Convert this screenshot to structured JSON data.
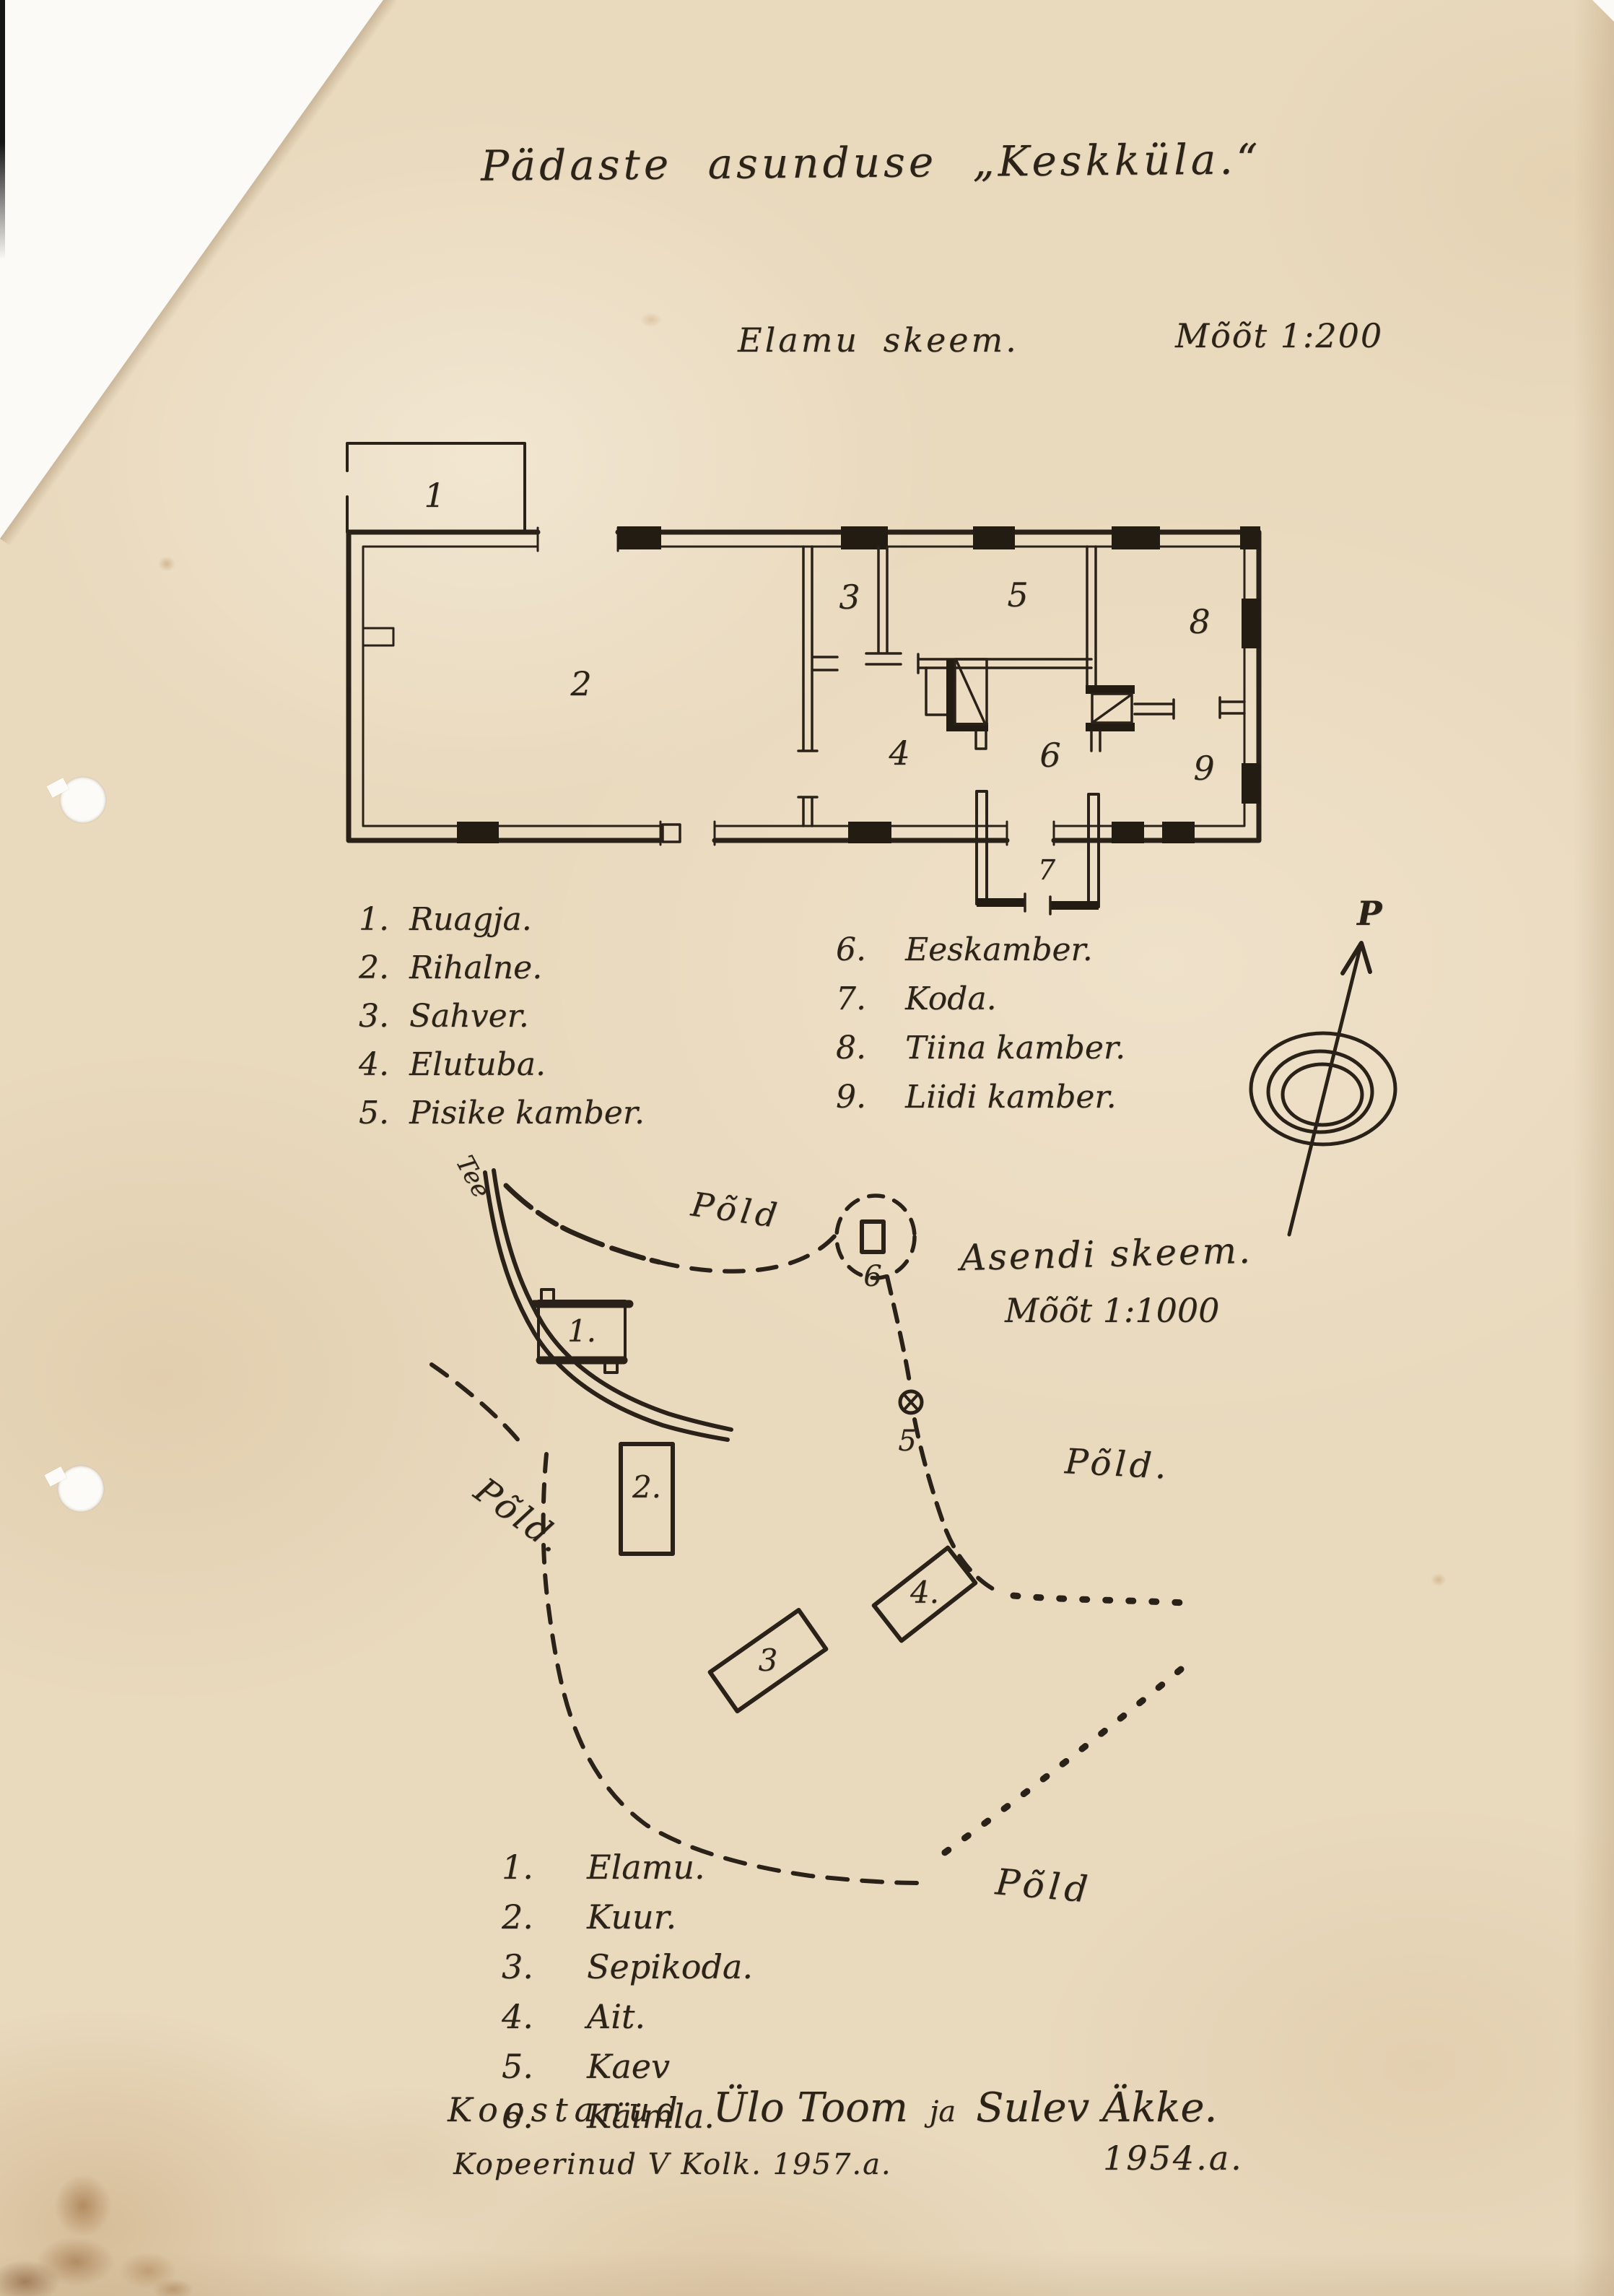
{
  "document": {
    "title": "Pädaste asunduse „Keskküla.“"
  },
  "floor_plan": {
    "heading": "Elamu skeem.",
    "scale": "Mõõt 1:200",
    "rooms": {
      "r1": "1",
      "r2": "2",
      "r3": "3",
      "r4": "4",
      "r5": "5",
      "r6": "6",
      "r7": "7",
      "r8": "8",
      "r9": "9"
    },
    "legend_left": [
      {
        "num": "1.",
        "label": "Ruagja."
      },
      {
        "num": "2.",
        "label": "Rihalne."
      },
      {
        "num": "3.",
        "label": "Sahver."
      },
      {
        "num": "4.",
        "label": "Elutuba."
      },
      {
        "num": "5.",
        "label": "Pisike kamber."
      }
    ],
    "legend_right": [
      {
        "num": "6.",
        "label": "Eeskamber."
      },
      {
        "num": "7.",
        "label": "Koda."
      },
      {
        "num": "8.",
        "label": "Tiina kamber."
      },
      {
        "num": "9.",
        "label": "Liidi kamber."
      }
    ]
  },
  "site_plan": {
    "heading": "Asendi skeem.",
    "scale": "Mõõt 1:1000",
    "compass_label": "P",
    "road_label": "Tee",
    "fields": {
      "top": "Põld",
      "left": "Põld.",
      "right": "Põld.",
      "bottom": "Põld"
    },
    "markers": {
      "b1": "1.",
      "b2": "2.",
      "b3": "3",
      "b4": "4.",
      "b5": "5",
      "b6": "6"
    },
    "legend": [
      {
        "num": "1.",
        "label": "Elamu."
      },
      {
        "num": "2.",
        "label": "Kuur."
      },
      {
        "num": "3.",
        "label": "Sepikoda."
      },
      {
        "num": "4.",
        "label": "Ait."
      },
      {
        "num": "5.",
        "label": "Kaev"
      },
      {
        "num": "6.",
        "label": "Käimla."
      }
    ]
  },
  "credits": {
    "prefix": "Koostanud",
    "name1": "Ülo Toom",
    "conj": "ja",
    "name2": "Sulev Äkke.",
    "copy_line": "Kopeerinud V Kolk. 1957.a.",
    "year_right": "1954.a."
  }
}
